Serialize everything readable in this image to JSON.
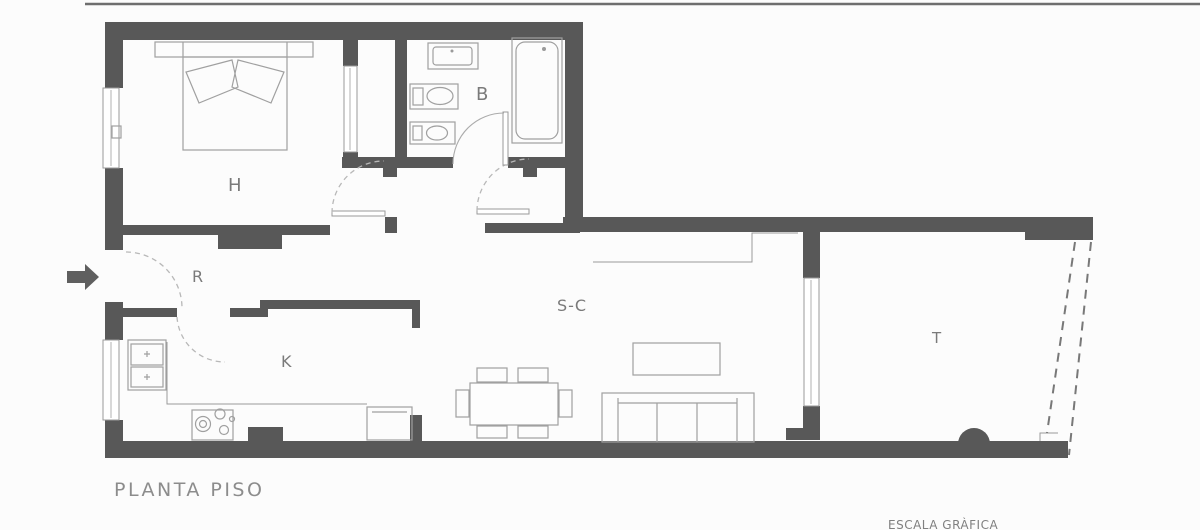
{
  "plan": {
    "title": "PLANTA PISO",
    "scale_label": "ESCALA GRÀFICA",
    "rooms": {
      "bedroom": "H",
      "bathroom": "B",
      "hall": "R",
      "kitchen": "K",
      "living_dining": "S-C",
      "terrace": "T"
    }
  },
  "icons": {
    "entry_arrow": "right-arrow"
  },
  "colors": {
    "wall": "#585858",
    "furniture_line": "#a0a0a0",
    "label_text": "#7a7a7a",
    "door_arc": "#b8b8b8",
    "background": "#fcfcfc"
  }
}
